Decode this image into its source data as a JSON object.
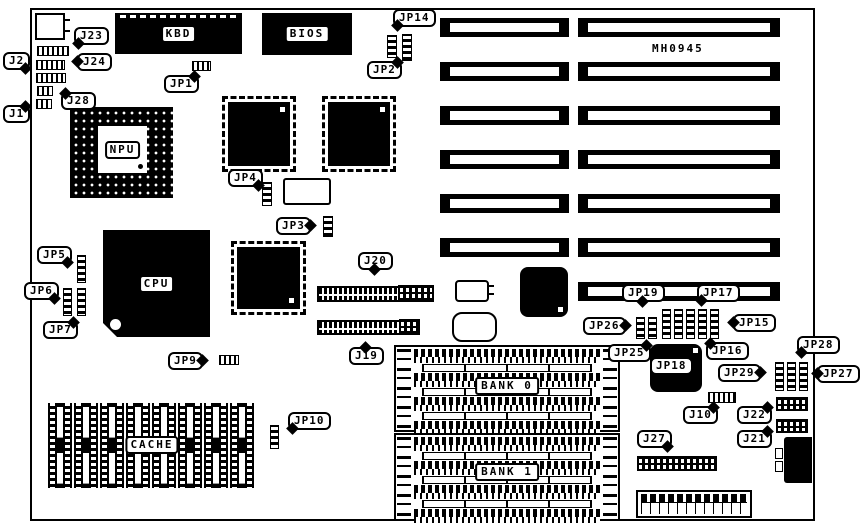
{
  "board": {
    "code": "MH0945"
  },
  "chips": {
    "kbd": "KBD",
    "bios": "BIOS",
    "npu": "NPU",
    "cpu": "CPU",
    "cache": "CACHE",
    "bank0": "BANK 0",
    "bank1": "BANK 1"
  },
  "callouts": {
    "j1": "J1",
    "j2": "J2",
    "j23": "J23",
    "j24": "J24",
    "j28": "J28",
    "jp1": "JP1",
    "jp14": "JP14",
    "jp2": "JP2",
    "jp4": "JP4",
    "jp3": "JP3",
    "jp5": "JP5",
    "jp6": "JP6",
    "jp7": "JP7",
    "jp9": "JP9",
    "j20": "J20",
    "j19": "J19",
    "jp10": "JP10",
    "jp19": "JP19",
    "jp17": "JP17",
    "jp26": "JP26",
    "jp25": "JP25",
    "jp15": "JP15",
    "jp16": "JP16",
    "jp18": "JP18",
    "jp29": "JP29",
    "jp28": "JP28",
    "jp27": "JP27",
    "j10": "J10",
    "j22": "J22",
    "j21": "J21",
    "j27": "J27"
  }
}
